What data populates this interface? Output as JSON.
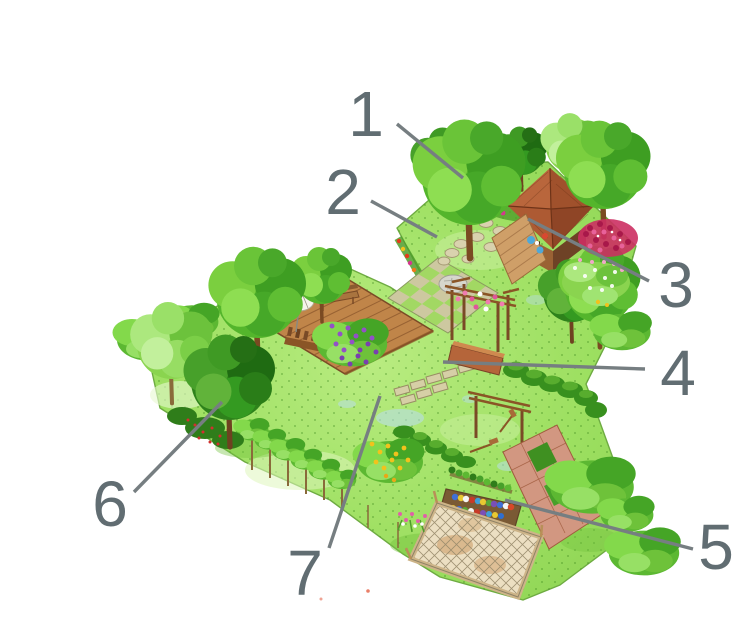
{
  "figure": {
    "callouts": [
      {
        "label": "1",
        "x": 366,
        "y": 136,
        "line": {
          "x1": 397,
          "y1": 124,
          "x2": 463,
          "y2": 178
        }
      },
      {
        "label": "2",
        "x": 343,
        "y": 214,
        "line": {
          "x1": 371,
          "y1": 201,
          "x2": 437,
          "y2": 237
        }
      },
      {
        "label": "3",
        "x": 676,
        "y": 307,
        "line": {
          "x1": 649,
          "y1": 281,
          "x2": 528,
          "y2": 219
        }
      },
      {
        "label": "4",
        "x": 678,
        "y": 395,
        "line": {
          "x1": 645,
          "y1": 369,
          "x2": 443,
          "y2": 362
        }
      },
      {
        "label": "5",
        "x": 716,
        "y": 569,
        "line": {
          "x1": 693,
          "y1": 549,
          "x2": 505,
          "y2": 500
        }
      },
      {
        "label": "6",
        "x": 110,
        "y": 526,
        "line": {
          "x1": 134,
          "y1": 492,
          "x2": 222,
          "y2": 402
        }
      },
      {
        "label": "7",
        "x": 305,
        "y": 595,
        "line": {
          "x1": 329,
          "y1": 548,
          "x2": 380,
          "y2": 396
        }
      }
    ],
    "palette": {
      "background": "#ffffff",
      "callout_text": "#616d72",
      "leader_line": "#767e81",
      "lawn": "#9adf5c",
      "foliage_mid": "#54b52c",
      "foliage_dark": "#2e821b",
      "foliage_light": "#8ad44f",
      "deck_wood": "#c08549",
      "shed_roof": "#a0512c",
      "paving_stone": "#d6cfa6",
      "rose_magenta": "#cc2f62",
      "wisteria_purple": "#9350c8",
      "flower_yellow": "#f2c21c",
      "flower_red": "#e23c1c"
    }
  }
}
